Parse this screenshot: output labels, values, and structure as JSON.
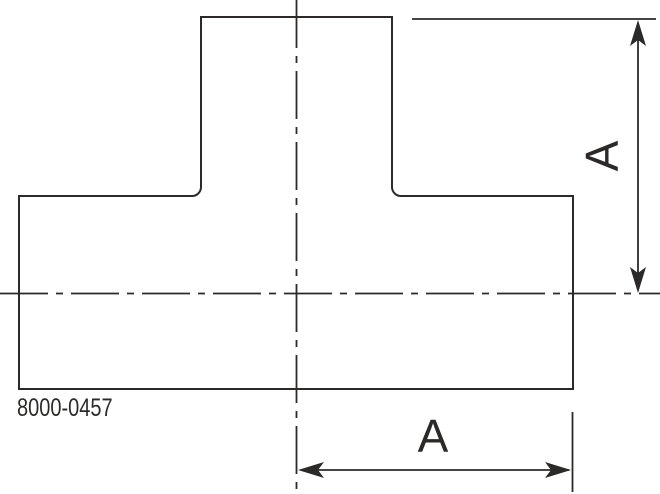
{
  "drawing": {
    "part_number": "8000-0457",
    "dimensions": {
      "vertical": {
        "label": "A"
      },
      "horizontal": {
        "label": "A"
      }
    }
  },
  "colors": {
    "line": "#2b2a29",
    "background": "#ffffff"
  }
}
